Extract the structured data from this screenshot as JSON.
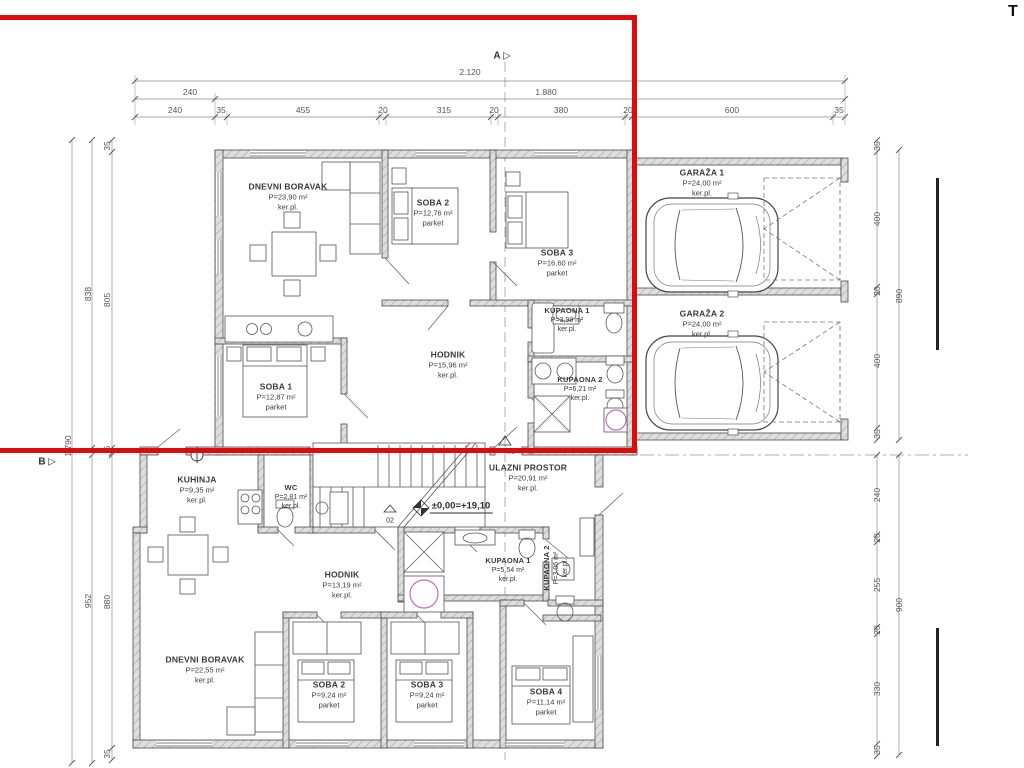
{
  "drawing": {
    "corner_letter": "T",
    "level_mark": "±0,00=+19,10",
    "grid_markers": {
      "a": "A",
      "b": "B",
      "arrow": "▷"
    },
    "door_tags": {
      "d01": "01",
      "d02": "02"
    },
    "floors": {
      "upper": {
        "rooms": [
          {
            "name": "DNEVNI BORAVAK",
            "area": "P=23,90 m²",
            "floor": "ker.pl."
          },
          {
            "name": "SOBA 2",
            "area": "P=12,76 m²",
            "floor": "parket"
          },
          {
            "name": "SOBA 3",
            "area": "P=16,60 m²",
            "floor": "parket"
          },
          {
            "name": "KUPAONA 1",
            "area": "P=3,98 m²",
            "floor": "ker.pl."
          },
          {
            "name": "HODNIK",
            "area": "P=15,96 m²",
            "floor": "ker.pl."
          },
          {
            "name": "KUPAONA 2",
            "area": "P=6,21 m²",
            "floor": "ker.pl."
          },
          {
            "name": "SOBA 1",
            "area": "P=12,87 m²",
            "floor": "parket"
          }
        ]
      },
      "lower": {
        "rooms": [
          {
            "name": "KUHINJA",
            "area": "P=9,35 m²",
            "floor": "ker.pl."
          },
          {
            "name": "WC",
            "area": "P=2,81 m²",
            "floor": "ker.pl."
          },
          {
            "name": "ULAZNI PROSTOR",
            "area": "P=20,91 m²",
            "floor": "ker.pl."
          },
          {
            "name": "HODNIK",
            "area": "P=13,19 m²",
            "floor": "ker.pl."
          },
          {
            "name": "KUPAONA 1",
            "area": "P=5,54 m²",
            "floor": "ker.pl."
          },
          {
            "name": "KUPAONA 2",
            "area": "P=3,06 m²",
            "floor": "ker.pl."
          },
          {
            "name": "DNEVNI BORAVAK",
            "area": "P=22,55 m²",
            "floor": "ker.pl."
          },
          {
            "name": "SOBA 2",
            "area": "P=9,24 m²",
            "floor": "parket"
          },
          {
            "name": "SOBA 3",
            "area": "P=9,24 m²",
            "floor": "parket"
          },
          {
            "name": "SOBA 4",
            "area": "P=11,14 m²",
            "floor": "parket"
          }
        ]
      }
    },
    "garages": [
      {
        "name": "GARAŽA 1",
        "area": "P=24,00 m²",
        "floor": "ker.pl."
      },
      {
        "name": "GARAŽA 2",
        "area": "P=24,00 m²",
        "floor": "ker.pl."
      }
    ],
    "dims": {
      "top_total": "2.120",
      "top_row2": [
        "240",
        "1.880"
      ],
      "top_row3": [
        "240",
        "35",
        "455",
        "20",
        "315",
        "20",
        "380",
        "20",
        "600",
        "35"
      ],
      "left_upper": {
        "outer": "1.790",
        "middle": "838",
        "inner_top": "35",
        "inner_main": "805",
        "inner_bottom": "5"
      },
      "left_lower": {
        "middle": "952",
        "inner_main": "880",
        "inner_bottom": "35"
      },
      "right_upper": {
        "outer": "890",
        "segments": [
          "35",
          "400",
          "20",
          "400",
          "35"
        ]
      },
      "right_lower": {
        "outer": "900",
        "segments": [
          "240",
          "20",
          "255",
          "20",
          "330",
          "35"
        ]
      }
    }
  },
  "colors": {
    "overlay_red": "#dd0b0b",
    "wall_fill": "#dedede",
    "line": "#444444",
    "dim_line": "#8a8a8a"
  }
}
